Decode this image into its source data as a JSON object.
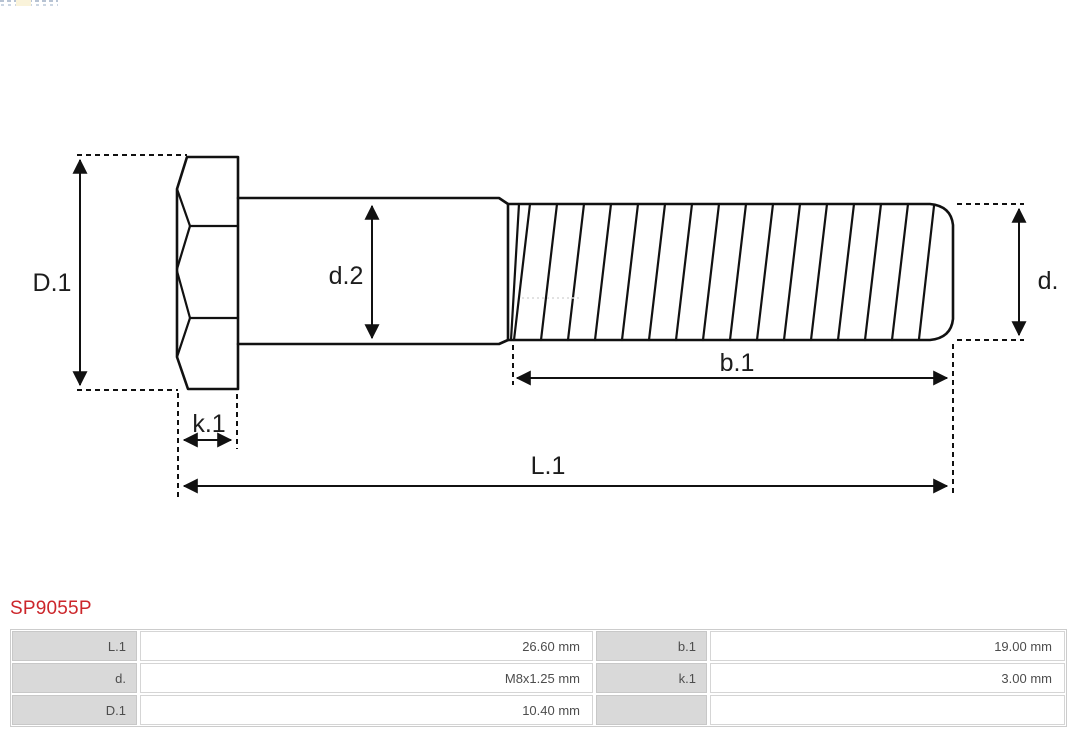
{
  "part": {
    "number": "SP9055P"
  },
  "diagram": {
    "labels": {
      "D1": "D.1",
      "d2": "d.2",
      "d": "d.",
      "b1": "b.1",
      "k1": "k.1",
      "L1": "L.1"
    }
  },
  "spec_table": {
    "rows": [
      {
        "c0": "L.1",
        "c1": "26.60 mm",
        "c2": "b.1",
        "c3": "19.00 mm"
      },
      {
        "c0": "d.",
        "c1": "M8x1.25 mm",
        "c2": "k.1",
        "c3": "3.00 mm"
      },
      {
        "c0": "D.1",
        "c1": "10.40 mm",
        "c2": "",
        "c3": ""
      }
    ]
  },
  "colors": {
    "part_number": "#cc262b",
    "table_label_bg": "#d9d9d9",
    "table_border": "#cccccc",
    "drawing_line": "#111111"
  }
}
